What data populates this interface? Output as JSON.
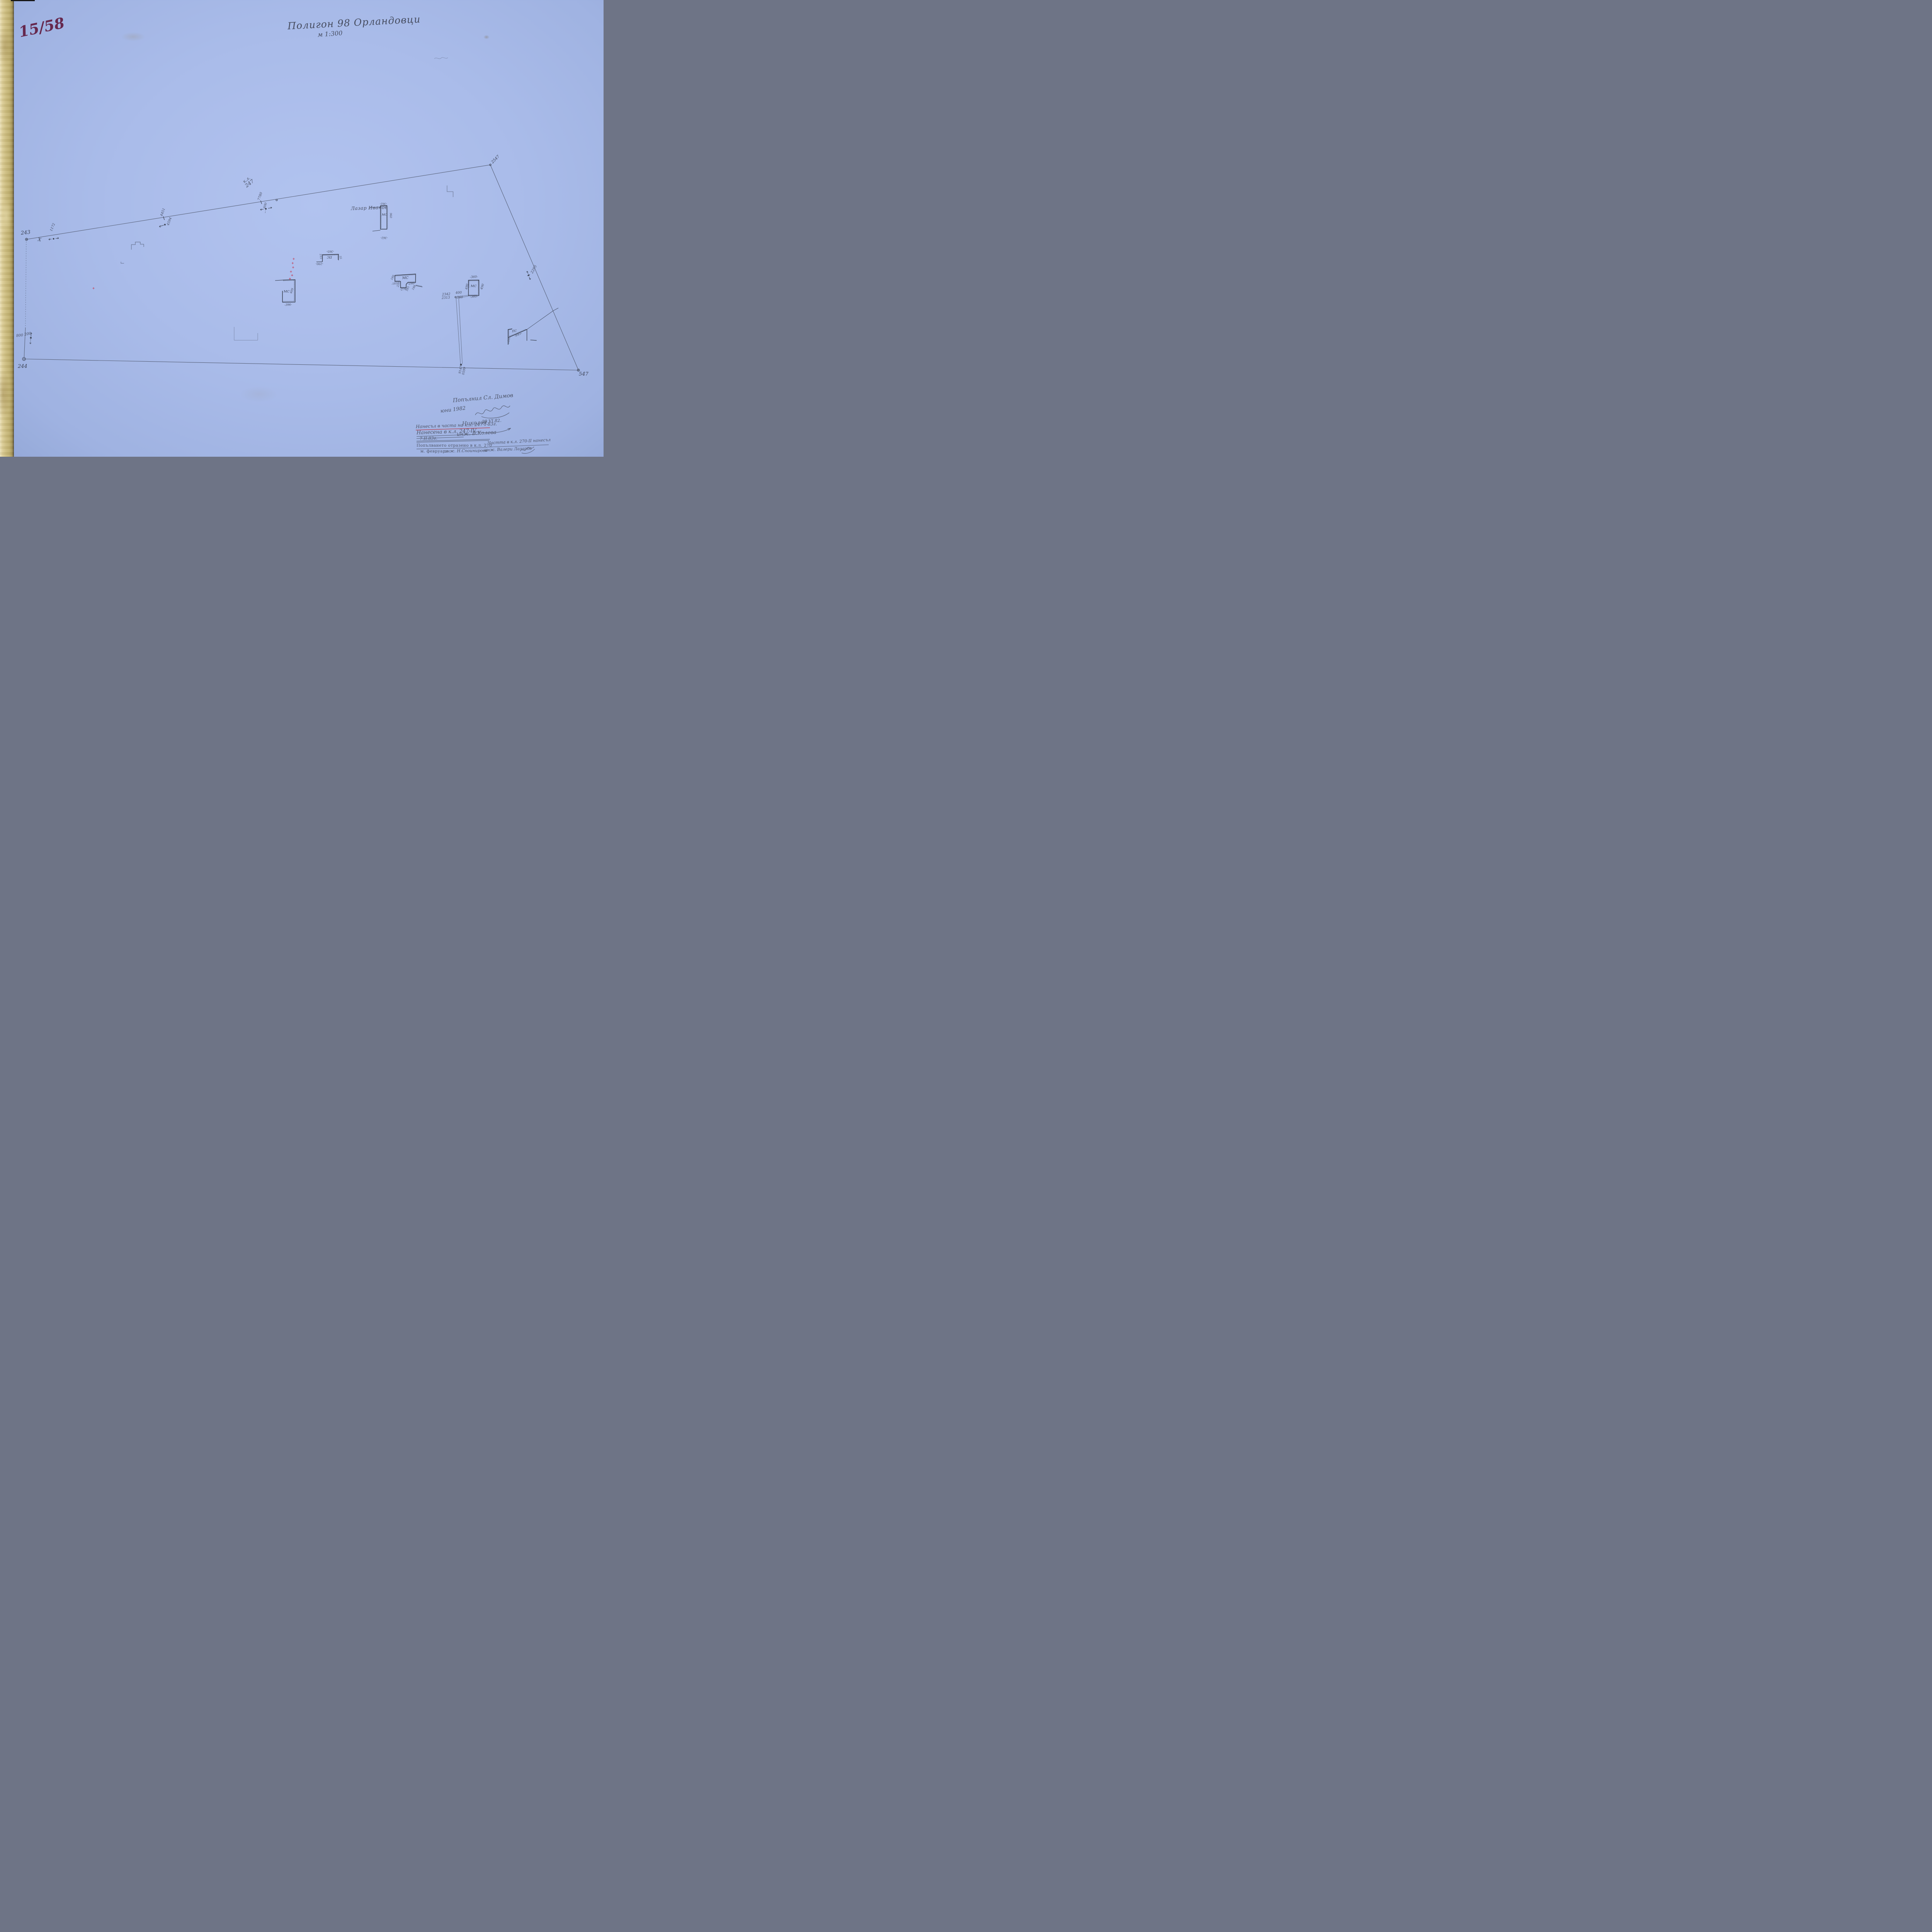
{
  "meta": {
    "sheet_number": "15/58",
    "title": "Полигон 98 Орландовци",
    "scale": "м 1:300"
  },
  "vertices": {
    "v243": "243",
    "v244": "244",
    "v547": "547",
    "v2547": "2547",
    "x_mark": "X"
  },
  "stations": {
    "s1172": "1172",
    "t4451": "4451",
    "t4594": "4594",
    "t7780": "7780",
    "t600": "600",
    "kl_line1": "к.л.",
    "kl_line2": "247",
    "s2295": "2295",
    "s800": "800",
    "s200": "200",
    "b9147": "9147",
    "b0599": "0599"
  },
  "owner": {
    "name": "Лазар Иванов"
  },
  "buildings": {
    "lazar": {
      "type": "МС",
      "dim_top": "-362-",
      "dim_right": "960",
      "dim_bottom": "-362-"
    },
    "ps_center": {
      "type": "ПС",
      "dim_top": "-365-",
      "dim_left": "215",
      "dim_bottom": "-290-",
      "dim_right": "55"
    },
    "ms_center": {
      "type": "МС",
      "dim_right": "409",
      "dim_bottom": "-396-"
    },
    "ms_u": {
      "type": "МС",
      "d180": "180",
      "d182": "-182-",
      "d220": "220",
      "d276": "-276-",
      "d185": "185",
      "d290": "-290-",
      "d188": "188"
    },
    "ms_square": {
      "type": "МС",
      "dim_top": "-360-",
      "dim_left": "490",
      "dim_right": "490",
      "dim_bottom": "-360-",
      "ref1": "2342",
      "ref2": "2313",
      "d400": "400",
      "d760": "760"
    },
    "ps_right": {
      "type": "ПС",
      "d845": "-845-",
      "d195": "-195-"
    }
  },
  "notes": {
    "filled_by": "Попълнил Сл. Димов",
    "filled_date": "юни 1982",
    "checked_date": "29.VI.82.",
    "entered_part": "Нанесъл в часта на к.л. 247-I-83г.",
    "entered_sig": "Николов",
    "entered_kl": "Нанесена в к.л. 247-IV,",
    "entered_eng": "инж. В.Колева",
    "entered_date": "7.II.83г.",
    "reflected": "Попълването отразено в к.л. 270",
    "part_kl": "Частта в к.л. 270-II нанесъл",
    "month": "м. февруари",
    "eng2": "инж. Н.Споинирова",
    "eng3": "инж. Валери Лазаров"
  }
}
